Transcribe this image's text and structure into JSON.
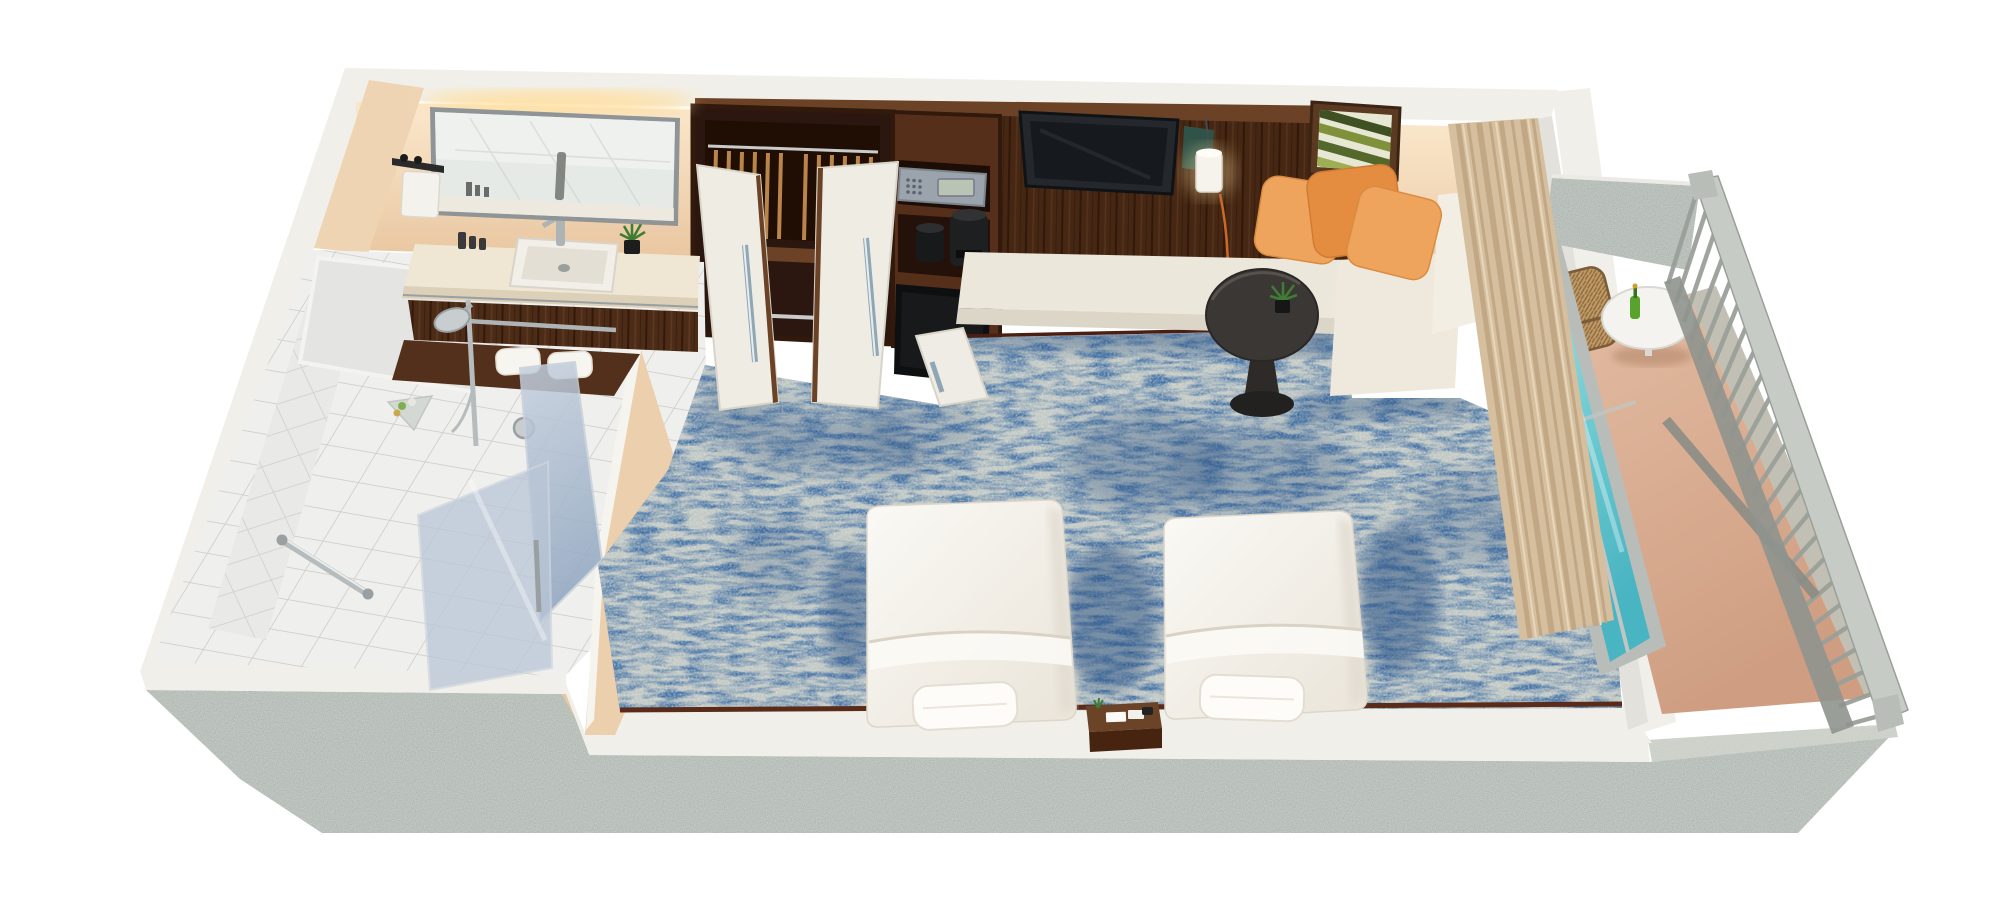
{
  "scene": {
    "type": "3d-render-floorplan",
    "subject": "Hotel twin guest room cutaway floor plan with bathroom, wardrobe, twin beds and balcony",
    "view": "isometric top-down oblique",
    "visible_text": "none",
    "background": "#ffffff"
  },
  "colors": {
    "background": "#ffffff",
    "concrete": "#a9b1ab",
    "concrete_light": "#c6cbc3",
    "rim_white": "#f1efe9",
    "peach_wall": "#f3dcbf",
    "peach_deep": "#e9c8a3",
    "warm_glow": "#ffdf9f",
    "wood_dark": "#4c2b17",
    "wood_mid": "#6b4226",
    "wood_deep": "#31190c",
    "closet_interior": "#2c1710",
    "tile_floor": "#eff0ee",
    "tile_wall": "#e9eae8",
    "grout": "#d2d0ca",
    "carpet": "#4674a8",
    "carpet_shadow": "#2c5183",
    "carpet_fleck": "#cfc49e",
    "bed_white": "#f6f4ef",
    "bed_shade": "#e1dbd0",
    "pillow_orange": "#efa45d",
    "pillow_orange_deep": "#e48d41",
    "bench_cream": "#ece7db",
    "sofa_cream": "#efe9dd",
    "curtain": "#d5bf9f",
    "curtain_deep": "#c1a784",
    "glass_teal": "#62c3cd",
    "glass_teal_light": "#a8dfe2",
    "glass_blue_grey": "#a3b4cb",
    "chrome": "#aeb4b6",
    "railing": "#9aa099",
    "railing_light": "#c7cbc5",
    "balcony_floor": "#d8ab8f",
    "table_dark": "#3b3734",
    "tv_screen": "#16191d",
    "tv_bezel": "#24282c",
    "safe": "#9ba3ac",
    "appliance_black": "#17191b",
    "trim_redwood": "#5a2b18",
    "plant_green": "#3f7d35",
    "bottle_green": "#58a32e",
    "wicker": "#c19a64"
  },
  "elements": [
    {
      "name": "bathroom-vanity",
      "label": "vanity counter with rectangular sink, faucet and potted plant"
    },
    {
      "name": "vanity-mirror",
      "label": "large lit mirror with warm cove light"
    },
    {
      "name": "towel-dispenser",
      "label": "white wall dispenser left of mirror"
    },
    {
      "name": "shower-room",
      "label": "tiled shower with rail shower head, corner shelf, grab bar and valve"
    },
    {
      "name": "shower-glass",
      "label": "blue-grey glass shower partitions"
    },
    {
      "name": "wardrobe",
      "label": "dark wood wardrobe with hangers and two open white doors"
    },
    {
      "name": "safe",
      "label": "in-wall electronic safe with keypad"
    },
    {
      "name": "coffee-station",
      "label": "ice bucket and coffee maker shelf"
    },
    {
      "name": "minibar-fridge",
      "label": "minibar fridge with open white door"
    },
    {
      "name": "tv",
      "label": "flat screen TV on dark wood media wall"
    },
    {
      "name": "pendant-lamp",
      "label": "white cylinder pendant lamp with cord"
    },
    {
      "name": "wall-art",
      "label": "framed green palm-leaf artwork"
    },
    {
      "name": "daybed-bench",
      "label": "long cream upholstered bench"
    },
    {
      "name": "sofa-pillows",
      "label": "sofa corner with three orange pillows"
    },
    {
      "name": "side-table",
      "label": "round dark pedestal table with small plant"
    },
    {
      "name": "carpet",
      "label": "blue mottled carpet with beige flecks"
    },
    {
      "name": "bed-left",
      "label": "twin bed with white duvet and pillow"
    },
    {
      "name": "bed-right",
      "label": "twin bed with white duvet and pillow"
    },
    {
      "name": "nightstand",
      "label": "wood nightstand between beds"
    },
    {
      "name": "curtain",
      "label": "tan floor-to-ceiling curtain"
    },
    {
      "name": "glass-door",
      "label": "teal glass sliding balcony door"
    },
    {
      "name": "balcony",
      "label": "balcony with tan deck"
    },
    {
      "name": "balcony-railing",
      "label": "grey baluster railing"
    },
    {
      "name": "balcony-table",
      "label": "white round table with champagne bottle"
    },
    {
      "name": "wicker-chair",
      "label": "wicker balcony chair"
    },
    {
      "name": "concrete-shell",
      "label": "speckled grey concrete outer walls"
    }
  ]
}
